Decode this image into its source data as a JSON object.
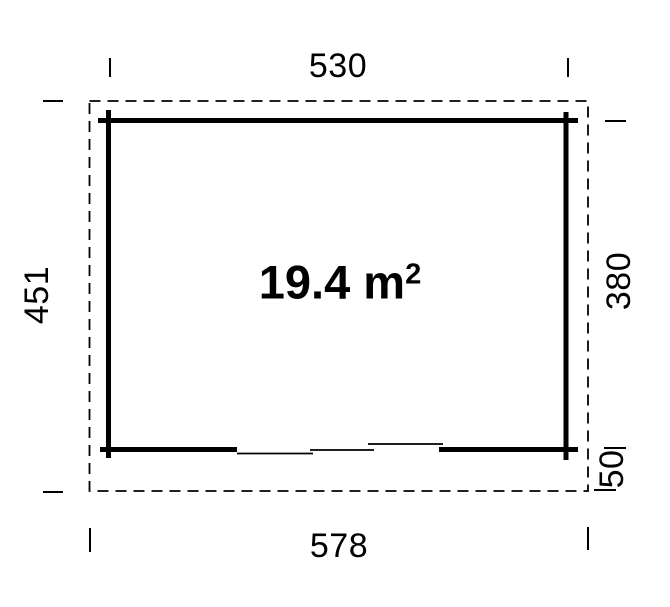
{
  "plan": {
    "title": "garden-house floor plan",
    "area": {
      "text": "19.4 m",
      "superscript": "2"
    },
    "dimensions": {
      "top_width": "530",
      "bottom_width": "578",
      "left_height": "451",
      "right_height": "380",
      "right_offset": "50"
    },
    "colors": {
      "line": "#000000",
      "background": "#ffffff"
    }
  }
}
